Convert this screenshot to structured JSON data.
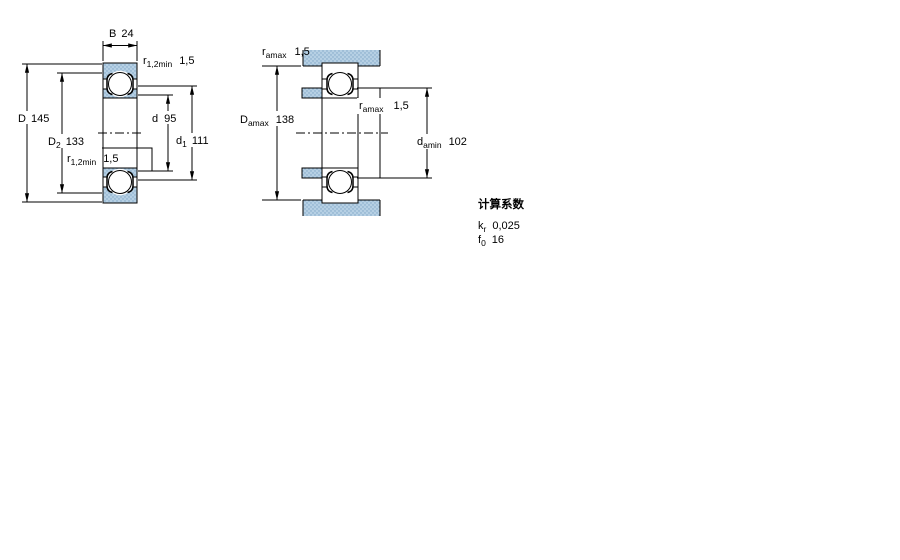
{
  "figure": {
    "left": {
      "dim_B": {
        "label": "B",
        "value": "24"
      },
      "dim_r12_top": {
        "base": "r",
        "sub": "1,2min",
        "value": "1,5"
      },
      "dim_r12_bot": {
        "base": "r",
        "sub": "1,2min",
        "value": "1,5"
      },
      "dim_D": {
        "label": "D",
        "value": "145"
      },
      "dim_D2": {
        "base": "D",
        "sub": "2",
        "value": "133"
      },
      "dim_d": {
        "label": "d",
        "value": "95"
      },
      "dim_d1": {
        "base": "d",
        "sub": "1",
        "value": "111"
      }
    },
    "right": {
      "dim_ra_top": {
        "base": "r",
        "sub": "amax",
        "value": "1,5"
      },
      "dim_Da": {
        "base": "D",
        "sub": "amax",
        "value": "138"
      },
      "dim_ra_mid": {
        "base": "r",
        "sub": "amax",
        "value": "1,5"
      },
      "dim_da": {
        "base": "d",
        "sub": "amin",
        "value": "102"
      }
    }
  },
  "calculation_factors": {
    "title": "计算系数",
    "kr": {
      "base": "k",
      "sub": "r",
      "value": "0,025"
    },
    "f0": {
      "base": "f",
      "sub": "0",
      "value": "16"
    }
  },
  "colors": {
    "ring_fill": "#b6d0e4",
    "ring_dot": "#7fa6c6",
    "line": "#000000",
    "background": "#ffffff"
  }
}
